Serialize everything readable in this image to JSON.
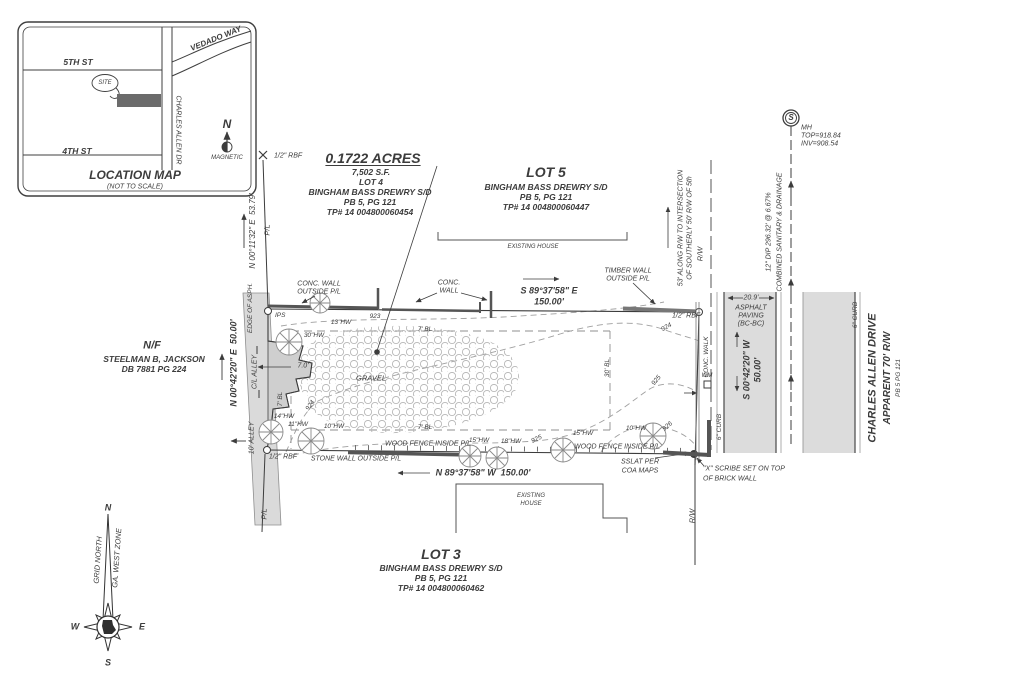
{
  "sheet": {
    "kind": "boundary-survey-plat"
  },
  "palette": {
    "ink": "#3c3c3c",
    "light_line": "#9a9a9a",
    "road_fill": "#dcdcdc",
    "wall_fill": "#cfcfcf",
    "site_fill": "#6b6b6b"
  },
  "labels": [
    {
      "n": "map-street-5th",
      "t": "5TH ST",
      "x": 78,
      "y": 62,
      "s": 8.5,
      "w": "b"
    },
    {
      "n": "map-street-4th",
      "t": "4TH ST",
      "x": 77,
      "y": 151,
      "s": 8.5,
      "w": "b"
    },
    {
      "n": "map-street-charles-allen",
      "t": "CHARLES ALLEN DR",
      "x": 178,
      "y": 130,
      "r": 90,
      "s": 7
    },
    {
      "n": "map-street-vedado",
      "t": "VEDADO WAY",
      "x": 216,
      "y": 39,
      "r": -22,
      "s": 8,
      "w": "b"
    },
    {
      "n": "map-site-label",
      "t": "SITE",
      "x": 105,
      "y": 83,
      "s": 6
    },
    {
      "n": "map-north-letter",
      "t": "N",
      "x": 227,
      "y": 124,
      "s": 12,
      "w": "b"
    },
    {
      "n": "map-north-magnetic",
      "t": "MAGNETIC",
      "x": 227,
      "y": 158,
      "s": 6
    },
    {
      "n": "map-title",
      "t": "LOCATION MAP",
      "x": 135,
      "y": 175,
      "s": 12,
      "w": "b"
    },
    {
      "n": "map-subtitle",
      "t": "(NOT TO SCALE)",
      "x": 135,
      "y": 187,
      "s": 7
    },
    {
      "n": "rbf-northwest",
      "t": "1/2\" RBF",
      "x": 274,
      "y": 156,
      "s": 7,
      "a": "l"
    },
    {
      "n": "dim-pl-north",
      "t": "N 00°11'32\" E  53.79'",
      "x": 253,
      "y": 231,
      "r": -90,
      "s": 8
    },
    {
      "n": "pl-north",
      "t": "P/L",
      "x": 267,
      "y": 230,
      "r": -90,
      "s": 7.5
    },
    {
      "n": "lot4-acres",
      "t": "0.1722 ACRES",
      "x": 373,
      "y": 158,
      "s": 14,
      "w": "b",
      "u": true
    },
    {
      "n": "lot4-sf",
      "t": "7,502 S.F.",
      "x": 371,
      "y": 172,
      "s": 8.5,
      "w": "b"
    },
    {
      "n": "lot4-name",
      "t": "LOT 4",
      "x": 371,
      "y": 182,
      "s": 8.5,
      "w": "b"
    },
    {
      "n": "lot4-subdivision",
      "t": "BINGHAM BASS DREWRY S/D",
      "x": 370,
      "y": 192,
      "s": 8.5,
      "w": "b"
    },
    {
      "n": "lot4-plat",
      "t": "PB 5, PG 121",
      "x": 370,
      "y": 202,
      "s": 8.5,
      "w": "b"
    },
    {
      "n": "lot4-parcel",
      "t": "TP# 14 004800060454",
      "x": 370,
      "y": 212,
      "s": 8.5,
      "w": "b"
    },
    {
      "n": "lot5-name",
      "t": "LOT 5",
      "x": 546,
      "y": 172,
      "s": 14,
      "w": "b"
    },
    {
      "n": "lot5-subdivision",
      "t": "BINGHAM BASS DREWRY S/D",
      "x": 546,
      "y": 187,
      "s": 8.5,
      "w": "b"
    },
    {
      "n": "lot5-plat",
      "t": "PB 5, PG 121",
      "x": 546,
      "y": 197,
      "s": 8.5,
      "w": "b"
    },
    {
      "n": "lot5-parcel",
      "t": "TP# 14 004800060447",
      "x": 546,
      "y": 207,
      "s": 8.5,
      "w": "b"
    },
    {
      "n": "existing-house-north-label",
      "t": "EXISTING HOUSE",
      "x": 533,
      "y": 247,
      "s": 6
    },
    {
      "n": "manhole-letter",
      "t": "S",
      "x": 791,
      "y": 118,
      "s": 8,
      "w": "b"
    },
    {
      "n": "manhole-mh",
      "t": "MH",
      "x": 801,
      "y": 128,
      "s": 7,
      "a": "l"
    },
    {
      "n": "manhole-top",
      "t": "TOP=918.84",
      "x": 801,
      "y": 136,
      "s": 7,
      "a": "l"
    },
    {
      "n": "manhole-inv",
      "t": "INV=908.54",
      "x": 801,
      "y": 144,
      "s": 7,
      "a": "l"
    },
    {
      "n": "sewer-pipe-note",
      "t": "12\" DIP 296.32' @ 6.67%",
      "x": 769,
      "y": 232,
      "r": -90,
      "s": 7
    },
    {
      "n": "sewer-type-note",
      "t": "COMBINED SANITARY & DRAINAGE",
      "x": 780,
      "y": 232,
      "r": -90,
      "s": 7
    },
    {
      "n": "rw-note-line1",
      "t": "53' ALONG R/W TO INTERSECTION",
      "x": 681,
      "y": 228,
      "r": -90,
      "s": 7
    },
    {
      "n": "rw-note-line2",
      "t": "OF SOUTHERLY 50' R/W OF 5th",
      "x": 690,
      "y": 228,
      "r": -90,
      "s": 7
    },
    {
      "n": "rw-north-label",
      "t": "R/W",
      "x": 700,
      "y": 254,
      "r": -90,
      "s": 7.5
    },
    {
      "n": "conc-wall-west-label1",
      "t": "CONC. WALL",
      "x": 319,
      "y": 284,
      "s": 7
    },
    {
      "n": "conc-wall-west-label2",
      "t": "OUTSIDE P/L",
      "x": 319,
      "y": 292,
      "s": 7
    },
    {
      "n": "conc-wall-mid-label1",
      "t": "CONC.",
      "x": 449,
      "y": 283,
      "s": 7
    },
    {
      "n": "conc-wall-mid-label2",
      "t": "WALL",
      "x": 449,
      "y": 291,
      "s": 7
    },
    {
      "n": "timber-wall-label1",
      "t": "TIMBER WALL",
      "x": 628,
      "y": 271,
      "s": 7
    },
    {
      "n": "timber-wall-label2",
      "t": "OUTSIDE P/L",
      "x": 628,
      "y": 279,
      "s": 7
    },
    {
      "n": "dim-north-bearing",
      "t": "S 89°37'58\" E",
      "x": 549,
      "y": 291,
      "s": 9,
      "w": "b"
    },
    {
      "n": "dim-north-distance",
      "t": "150.00'",
      "x": 549,
      "y": 302,
      "s": 9,
      "w": "b"
    },
    {
      "n": "rbf-northeast",
      "t": "1/2\" RBF",
      "x": 672,
      "y": 316,
      "s": 7,
      "a": "l"
    },
    {
      "n": "ips-north-label",
      "t": "IPS",
      "x": 275,
      "y": 316,
      "s": 6.5,
      "a": "l"
    },
    {
      "n": "tree-13hw-label",
      "t": "13\"HW",
      "x": 341,
      "y": 323,
      "s": 6.5
    },
    {
      "n": "contour-923-label",
      "t": "923",
      "x": 375,
      "y": 317,
      "s": 6.5
    },
    {
      "n": "bl-north-label",
      "t": "7' BL",
      "x": 425,
      "y": 330,
      "s": 6.5
    },
    {
      "n": "tree-30hw-label",
      "t": "30\"HW",
      "x": 314,
      "y": 336,
      "s": 6.5
    },
    {
      "n": "dim-alley-offset",
      "t": "7.0'",
      "x": 303,
      "y": 366,
      "s": 7
    },
    {
      "n": "gravel-label",
      "t": "GRAVEL",
      "x": 371,
      "y": 378,
      "s": 7.5
    },
    {
      "n": "contour-924-label-west",
      "t": "924",
      "x": 311,
      "y": 406,
      "r": -55,
      "s": 6.5
    },
    {
      "n": "contour-924-label-east",
      "t": "924",
      "x": 667,
      "y": 328,
      "r": -30,
      "s": 6.5
    },
    {
      "n": "bl-west-label",
      "t": "7' BL",
      "x": 281,
      "y": 399,
      "r": -90,
      "s": 6.5
    },
    {
      "n": "tree-14hw-label",
      "t": "14\"HW",
      "x": 284,
      "y": 417,
      "s": 6.5
    },
    {
      "n": "tree-11hw-label",
      "t": "11\"HW",
      "x": 298,
      "y": 425,
      "s": 6.5
    },
    {
      "n": "tree-10hw-west-label",
      "t": "10\"HW",
      "x": 334,
      "y": 427,
      "s": 6.5
    },
    {
      "n": "bl-south-label",
      "t": "7' BL",
      "x": 425,
      "y": 428,
      "s": 6.5
    },
    {
      "n": "bl-east-label",
      "t": "30' BL",
      "x": 608,
      "y": 368,
      "r": -90,
      "s": 6.5
    },
    {
      "n": "contour-925-label-west",
      "t": "925",
      "x": 537,
      "y": 440,
      "r": -25,
      "s": 6.5
    },
    {
      "n": "contour-925-label-east",
      "t": "925",
      "x": 657,
      "y": 381,
      "r": -50,
      "s": 6.5
    },
    {
      "n": "contour-926-label",
      "t": "926",
      "x": 668,
      "y": 427,
      "r": -40,
      "s": 6.5
    },
    {
      "n": "tree-15hw-west-label",
      "t": "15\"HW",
      "x": 479,
      "y": 441,
      "s": 6.5
    },
    {
      "n": "tree-18hw-label",
      "t": "18\"HW",
      "x": 511,
      "y": 442,
      "s": 6.5
    },
    {
      "n": "wood-fence-west-label",
      "t": "WOOD FENCE INSIDE P/L",
      "x": 428,
      "y": 444,
      "s": 7
    },
    {
      "n": "tree-15hw-east-label",
      "t": "15\"HW",
      "x": 583,
      "y": 434,
      "s": 6.5
    },
    {
      "n": "tree-10hw-east-label",
      "t": "10\"HW",
      "x": 636,
      "y": 429,
      "s": 6.5
    },
    {
      "n": "wood-fence-east-label",
      "t": "WOOD FENCE INSIDE P/L",
      "x": 617,
      "y": 447,
      "s": 7
    },
    {
      "n": "sslat-label1",
      "t": "SSLAT PER",
      "x": 640,
      "y": 462,
      "s": 7
    },
    {
      "n": "sslat-label2",
      "t": "COA MAPS",
      "x": 640,
      "y": 471,
      "s": 7
    },
    {
      "n": "stone-wall-label",
      "t": "STONE WALL OUTSIDE P/L",
      "x": 356,
      "y": 459,
      "s": 7
    },
    {
      "n": "rbf-southwest",
      "t": "1/2\" RBF",
      "x": 283,
      "y": 457,
      "s": 7
    },
    {
      "n": "dim-south",
      "t": "N 89°37'58\" W  150.00'",
      "x": 483,
      "y": 473,
      "s": 9,
      "w": "b"
    },
    {
      "n": "existing-house-south-line1",
      "t": "EXISTING",
      "x": 531,
      "y": 496,
      "s": 6
    },
    {
      "n": "existing-house-south-line2",
      "t": "HOUSE",
      "x": 531,
      "y": 504,
      "s": 6
    },
    {
      "n": "lot3-name",
      "t": "LOT 3",
      "x": 441,
      "y": 554,
      "s": 14,
      "w": "b"
    },
    {
      "n": "lot3-subdivision",
      "t": "BINGHAM BASS DREWRY S/D",
      "x": 441,
      "y": 568,
      "s": 8.5,
      "w": "b"
    },
    {
      "n": "lot3-plat",
      "t": "PB 5, PG 121",
      "x": 441,
      "y": 578,
      "s": 8.5,
      "w": "b"
    },
    {
      "n": "lot3-parcel",
      "t": "TP# 14 004800060462",
      "x": 441,
      "y": 588,
      "s": 8.5,
      "w": "b"
    },
    {
      "n": "adjoiner-nf",
      "t": "N/F",
      "x": 152,
      "y": 346,
      "s": 11,
      "w": "b"
    },
    {
      "n": "adjoiner-name",
      "t": "STEELMAN B, JACKSON",
      "x": 154,
      "y": 359,
      "s": 8.5,
      "w": "b"
    },
    {
      "n": "adjoiner-deed",
      "t": "DB 7881 PG 224",
      "x": 154,
      "y": 369,
      "s": 8.5,
      "w": "b"
    },
    {
      "n": "dim-west-bearing",
      "t": "N 00°42'20\" E  50.00'",
      "x": 234,
      "y": 363,
      "r": -90,
      "s": 9,
      "w": "b"
    },
    {
      "n": "edge-of-asphalt-label",
      "t": "EDGE OF ASPH.",
      "x": 251,
      "y": 308,
      "r": -90,
      "s": 6.5
    },
    {
      "n": "cl-alley-label",
      "t": "C/L ALLEY",
      "x": 255,
      "y": 372,
      "r": -90,
      "s": 7
    },
    {
      "n": "alley-width-label",
      "t": "10' ALLEY",
      "x": 252,
      "y": 438,
      "r": -90,
      "s": 7
    },
    {
      "n": "pl-south-label",
      "t": "P/L",
      "x": 264,
      "y": 514,
      "r": -90,
      "s": 7.5
    },
    {
      "n": "conc-walk-label",
      "t": "CONC. WALK",
      "x": 707,
      "y": 357,
      "r": -90,
      "s": 6.5
    },
    {
      "n": "wm-label",
      "t": "WM",
      "x": 707,
      "y": 376,
      "s": 6
    },
    {
      "n": "curb-west-label",
      "t": "6\" CURB",
      "x": 720,
      "y": 427,
      "r": -90,
      "s": 6.5
    },
    {
      "n": "asphalt-width",
      "t": "20.9'",
      "x": 751,
      "y": 298,
      "s": 7
    },
    {
      "n": "asphalt-label1",
      "t": "ASPHALT",
      "x": 751,
      "y": 308,
      "s": 7
    },
    {
      "n": "asphalt-label2",
      "t": "PAVING",
      "x": 751,
      "y": 316,
      "s": 7
    },
    {
      "n": "asphalt-label3",
      "t": "(BC-BC)",
      "x": 751,
      "y": 324,
      "s": 7
    },
    {
      "n": "dim-east-bearing",
      "t": "S 00°42'20\" W",
      "x": 747,
      "y": 370,
      "r": -90,
      "s": 9,
      "w": "b"
    },
    {
      "n": "dim-east-distance",
      "t": "50.00'",
      "x": 758,
      "y": 370,
      "r": -90,
      "s": 9,
      "w": "b"
    },
    {
      "n": "curb-east-label",
      "t": "6\" CURB",
      "x": 856,
      "y": 315,
      "r": -90,
      "s": 6.5
    },
    {
      "n": "street-name",
      "t": "CHARLES ALLEN DRIVE",
      "x": 873,
      "y": 378,
      "r": -90,
      "s": 11,
      "w": "b"
    },
    {
      "n": "street-rw",
      "t": "APPARENT 70' R/W",
      "x": 888,
      "y": 378,
      "r": -90,
      "s": 10,
      "w": "b"
    },
    {
      "n": "street-plat",
      "t": "PB 5 PG 121",
      "x": 899,
      "y": 378,
      "r": -90,
      "s": 6.5
    },
    {
      "n": "scribe-note-line1",
      "t": "\"X\" SCRIBE SET ON TOP",
      "x": 703,
      "y": 469,
      "s": 7,
      "a": "l"
    },
    {
      "n": "scribe-note-line2",
      "t": "OF BRICK WALL",
      "x": 703,
      "y": 479,
      "s": 7,
      "a": "l"
    },
    {
      "n": "rw-south-label",
      "t": "R/W",
      "x": 692,
      "y": 516,
      "r": -90,
      "s": 7.5
    },
    {
      "n": "compass-n",
      "t": "N",
      "x": 108,
      "y": 508,
      "s": 9,
      "w": "b"
    },
    {
      "n": "compass-w",
      "t": "W",
      "x": 75,
      "y": 627,
      "s": 9,
      "w": "b"
    },
    {
      "n": "compass-e",
      "t": "E",
      "x": 142,
      "y": 627,
      "s": 9,
      "w": "b"
    },
    {
      "n": "compass-s",
      "t": "S",
      "x": 108,
      "y": 663,
      "s": 9,
      "w": "b"
    },
    {
      "n": "compass-grid-north",
      "t": "GRID NORTH",
      "x": 98,
      "y": 560,
      "r": -86,
      "s": 7.5
    },
    {
      "n": "compass-zone",
      "t": "GA. WEST ZONE",
      "x": 117,
      "y": 558,
      "r": -86,
      "s": 7.5
    }
  ]
}
